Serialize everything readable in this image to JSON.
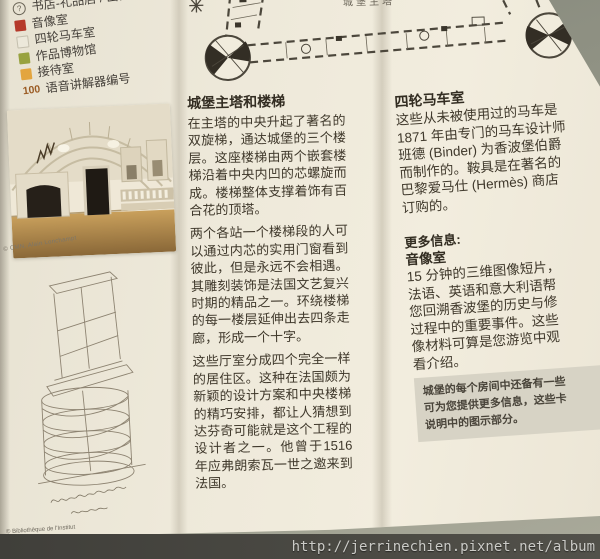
{
  "legend": {
    "items": [
      {
        "icon": "question-circle",
        "label": "书店-礼品店 / 出口"
      },
      {
        "swatch": "#b5392a",
        "label": "音像室"
      },
      {
        "swatch": "#ece8da",
        "label": "四轮马车室"
      },
      {
        "swatch": "#98a23f",
        "label": "作品博物馆"
      },
      {
        "swatch": "#e3a53f",
        "label": "接待室"
      },
      {
        "marker": "100",
        "label": "语音讲解器编号"
      }
    ]
  },
  "floorplan": {
    "label": "城堡主塔"
  },
  "photo": {
    "credit": "© CMN, Alain Lonchampt"
  },
  "sketch": {
    "credit": "© Bibliothèque de l'Institut"
  },
  "article": {
    "heading": "城堡主塔和楼梯",
    "para1": "在主塔的中央升起了著名的双旋梯，通达城堡的三个楼层。这座楼梯由两个嵌套楼梯沿着中央内凹的芯螺旋而成。楼梯整体支撑着饰有百合花的顶塔。",
    "para2": "两个各站一个楼梯段的人可以通过内芯的实用门窗看到彼此，但是永远不会相遇。其雕刻装饰是法国文艺复兴时期的精品之一。环绕楼梯的每一楼层延伸出去四条走廊，形成一个十字。",
    "para3": "这些厅室分成四个完全一样的居住区。这种在法国颇为新颖的设计方案和中央楼梯的精巧安排，都让人猜想到达芬奇可能就是这个工程的设计者之一。他曾于1516年应弗朗索瓦一世之邀来到法国。"
  },
  "coach_section": {
    "heading": "四轮马车室",
    "body": "这些从未被使用过的马车是\n1871 年由专门的马车设计师\n班德 (Binder) 为香波堡伯爵\n而制作的。鞍具是在著名的\n巴黎爱马仕 (Hermès) 商店\n订购的。",
    "more_info_label": "更多信息:",
    "subheading": "音像室",
    "body2": "15 分钟的三维图像短片，\n法语、英语和意大利语帮\n您回溯香波堡的历史与修\n过程中的重要事件。这些\n像材料可算是您游览中观\n看介绍。",
    "note": "城堡的每个房间中还备有一些\n可为您提供更多信息，这些卡\n说明中的图示部分。"
  },
  "watermark": "http://jerrinechien.pixnet.net/album"
}
